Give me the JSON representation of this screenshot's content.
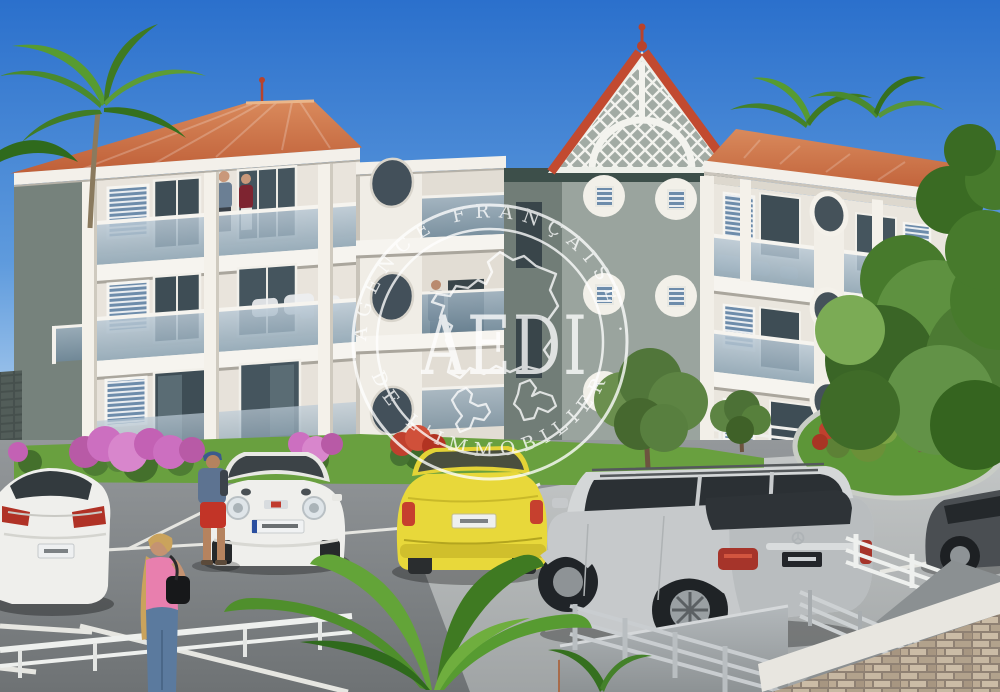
{
  "image": {
    "alt": "Architect 3D rendering of a three-storey white Caribbean apartment residence with terracotta hip roofs, a central lattice-work gable, glass balconies, palm trees, landscaped parking lot with five cars and strolling people, overlaid with a circular AEDI real-estate watermark stamp"
  },
  "watermark": {
    "brand": "AEDI",
    "arc_top": "AGENCE FRANÇAISE ·",
    "arc_bottom": "DE L'IMMOBILIER"
  },
  "colors": {
    "sky_top": "#2b70cc",
    "sky_mid": "#5f9bdd",
    "sky_horizon": "#c9e0f4",
    "roof_light": "#d98a5c",
    "roof_dark": "#bf5f38",
    "roof_red": "#c24a30",
    "wall_white": "#efece5",
    "tower_sage": "#9aa49e",
    "tower_side": "#76827c",
    "tower_band": "#3d4f4a",
    "lattice_white": "#f3f3ee",
    "glass_top": "#bccbd7",
    "glass_bottom": "#8aa2b2",
    "asphalt": "#7b7f81",
    "pavement": "#b6b9ba",
    "line_white": "#e6e6e1",
    "grass": "#69a03f",
    "foliage": "#5e9140",
    "foliage_dark": "#3a6526",
    "bougainvillea": "#cc6fc0",
    "flower_red": "#c0402e",
    "car_white": "#efefec",
    "car_yellow": "#e8d83a",
    "car_silver": "#c6c9cb",
    "car_dark": "#4a4e52",
    "fence_white": "#eef0ee",
    "railing_gray": "#c9cdd0",
    "stone_base": "#8f8173",
    "watermark_white": "#ffffff"
  }
}
